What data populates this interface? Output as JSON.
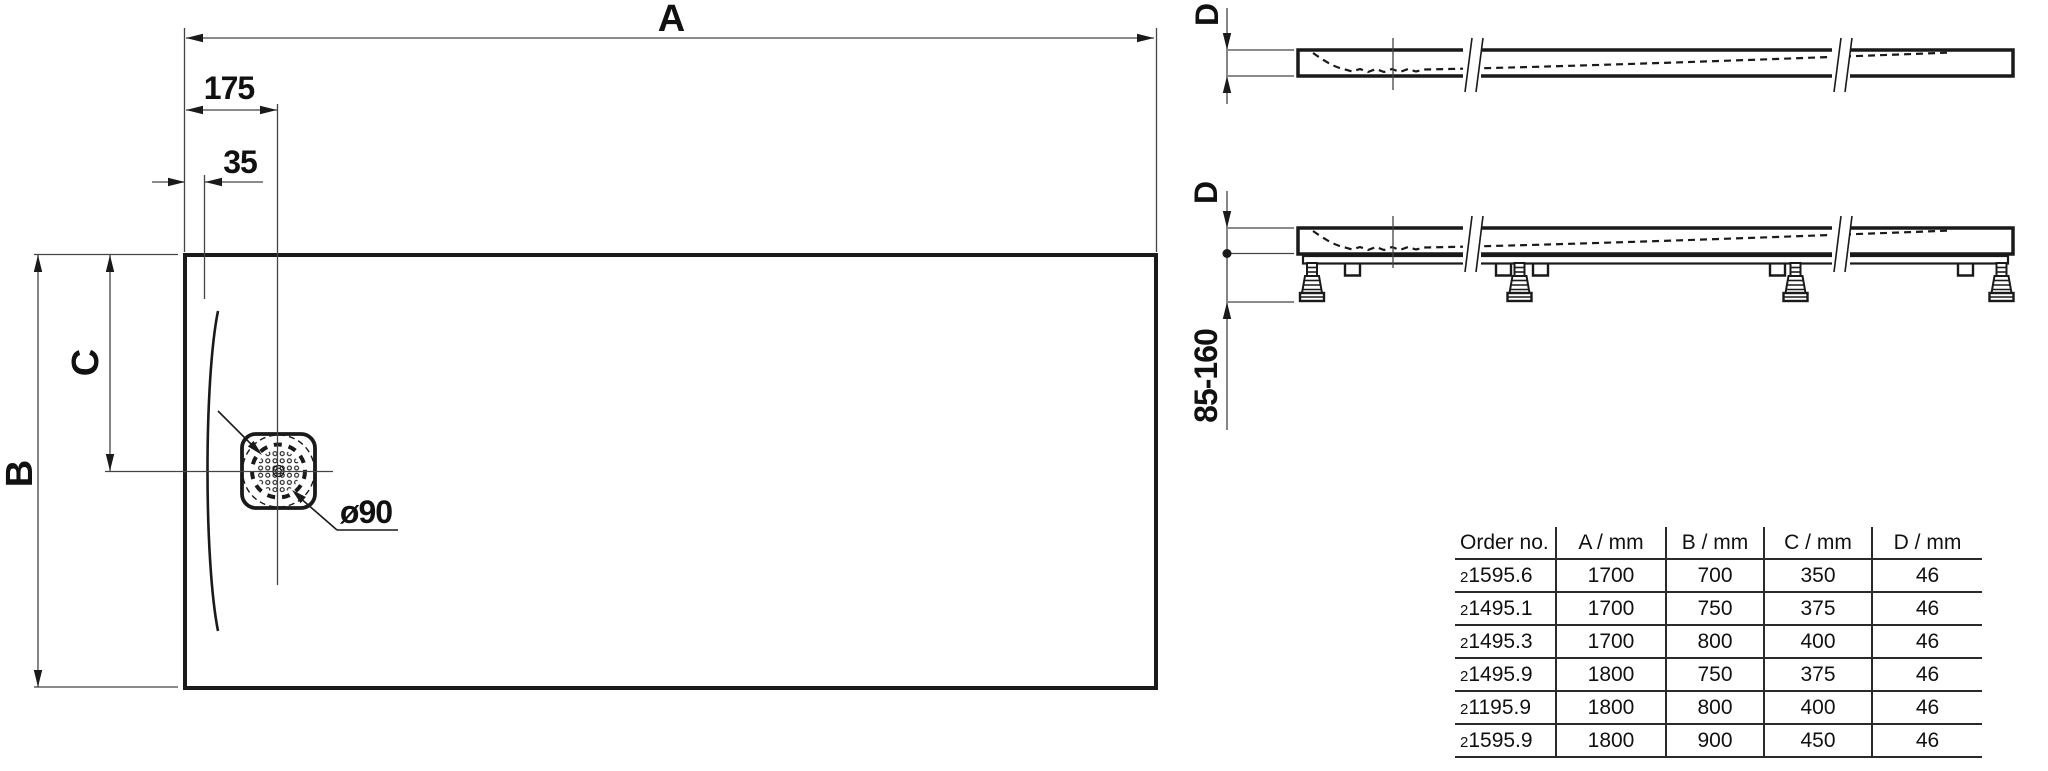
{
  "labels": {
    "dim_a": "A",
    "dim_b": "B",
    "dim_c": "C",
    "dim_175": "175",
    "dim_35": "35",
    "drain_diameter": "ø90",
    "dim_d_top_view": "D",
    "dim_d_front_view": "D",
    "feet_height_range": "85-160"
  },
  "table": {
    "headers": [
      "Order no.",
      "A / mm",
      "B / mm",
      "C / mm",
      "D / mm"
    ],
    "rows": [
      {
        "prefix": "2",
        "number": "1595.6",
        "a": "1700",
        "b": "700",
        "c": "350",
        "d": "46"
      },
      {
        "prefix": "2",
        "number": "1495.1",
        "a": "1700",
        "b": "750",
        "c": "375",
        "d": "46"
      },
      {
        "prefix": "2",
        "number": "1495.3",
        "a": "1700",
        "b": "800",
        "c": "400",
        "d": "46"
      },
      {
        "prefix": "2",
        "number": "1495.9",
        "a": "1800",
        "b": "750",
        "c": "375",
        "d": "46"
      },
      {
        "prefix": "2",
        "number": "1195.9",
        "a": "1800",
        "b": "800",
        "c": "400",
        "d": "46"
      },
      {
        "prefix": "2",
        "number": "1595.9",
        "a": "1800",
        "b": "900",
        "c": "450",
        "d": "46"
      }
    ]
  },
  "colors": {
    "line": "#1a1a1a",
    "thin_line": "#444444",
    "background": "#ffffff"
  }
}
